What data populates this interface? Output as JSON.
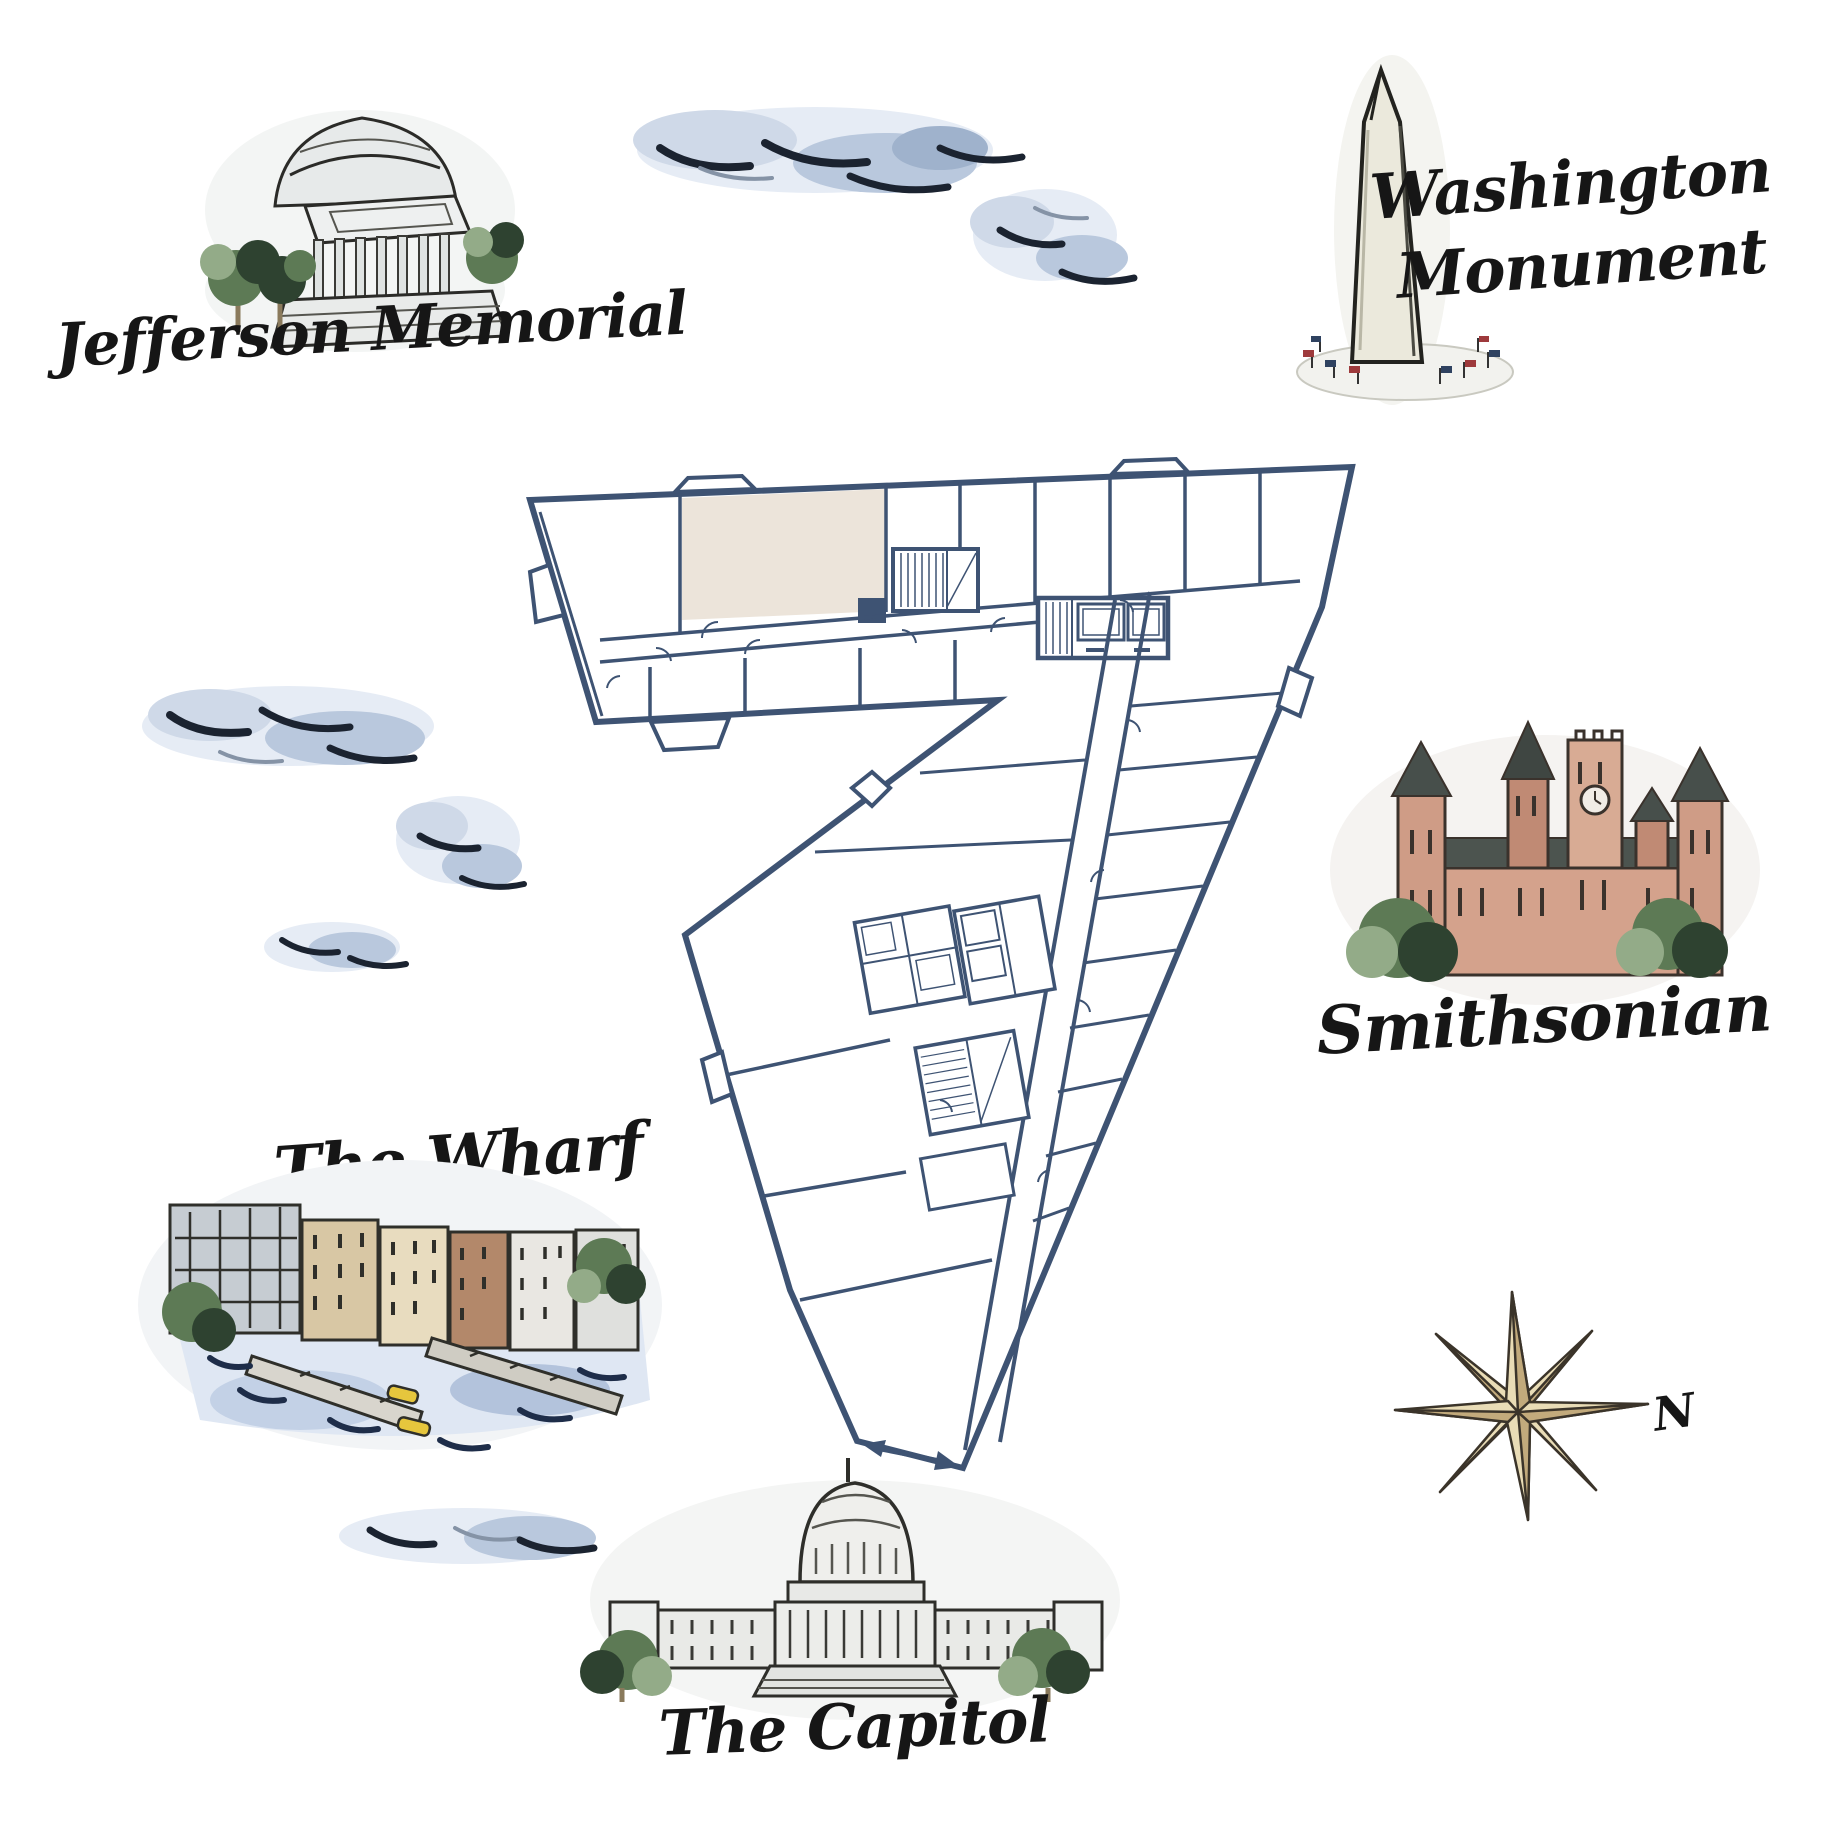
{
  "page": {
    "title": "Washington DC landmarks floor plan map",
    "width": 1836,
    "height": 1836,
    "background": "#ffffff"
  },
  "labels": {
    "jefferson": "Jefferson Memorial",
    "washington_line1": "Washington",
    "washington_line2": "Monument",
    "smithsonian": "Smithsonian",
    "wharf": "The Wharf",
    "capitol": "The Capitol",
    "compass_north": "N"
  },
  "colors": {
    "plan_wall": "#3e5373",
    "plan_highlight": "#ece4da",
    "label_ink": "#161616",
    "cloud_light": "#e6ecf5",
    "cloud_mid": "#b9c8dd",
    "cloud_dark": "#1b2330",
    "star_light": "#e9dcb6",
    "star_dark": "#c2aa7c",
    "stone_light": "#eceeec",
    "castle_wall": "#cf9c86",
    "roof_slate": "#474f4b",
    "water_blue": "#dfe7f3",
    "kayak_yellow": "#e6c63d"
  }
}
